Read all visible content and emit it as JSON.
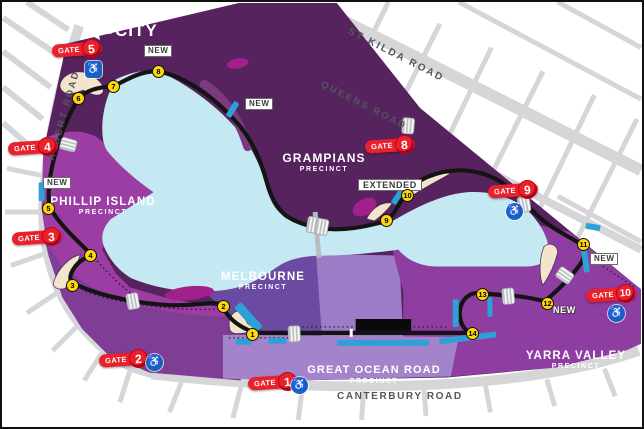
{
  "map": {
    "city": {
      "label": "CITY"
    },
    "roads": {
      "st_kilda": "ST KILDA ROAD",
      "queens": "QUEENS ROAD",
      "albert": "ALBERT ROAD",
      "canterbury": "CANTERBURY ROAD"
    },
    "precincts": {
      "phillip_island": {
        "name": "PHILLIP ISLAND",
        "sub": "PRECINCT"
      },
      "grampians": {
        "name": "GRAMPIANS",
        "sub": "PRECINCT"
      },
      "melbourne": {
        "name": "MELBOURNE",
        "sub": "PRECINCT"
      },
      "great_ocean_road": {
        "name": "GREAT OCEAN ROAD",
        "sub": "PRECINCT"
      },
      "yarra_valley": {
        "name": "YARRA VALLEY",
        "sub": "PRECINCT"
      }
    },
    "gates": [
      {
        "label": "GATE",
        "number": "1",
        "accessible": true
      },
      {
        "label": "GATE",
        "number": "2",
        "accessible": true
      },
      {
        "label": "GATE",
        "number": "3",
        "accessible": false
      },
      {
        "label": "GATE",
        "number": "4",
        "accessible": false
      },
      {
        "label": "GATE",
        "number": "5",
        "accessible": true
      },
      {
        "label": "GATE",
        "number": "8",
        "accessible": false
      },
      {
        "label": "GATE",
        "number": "9",
        "accessible": true
      },
      {
        "label": "GATE",
        "number": "10",
        "accessible": true
      }
    ],
    "turns": [
      "1",
      "2",
      "3",
      "4",
      "5",
      "6",
      "7",
      "8",
      "9",
      "10",
      "11",
      "12",
      "13",
      "14"
    ],
    "annotations": {
      "new": "NEW",
      "extended": "EXTENDED"
    },
    "icons": {
      "accessible": "♿"
    },
    "colors": {
      "precinct_dark": "#57235e",
      "precinct_bright": "#9c3da4",
      "precinct_mid": "#7f3d96",
      "melbourne": "#6b4aa2",
      "lavender_block": "#9c7cc6",
      "south_strip": "#a383ca",
      "yarra": "#8e3da0",
      "lake": "#c5e9f2",
      "track": "#141414",
      "road_gray": "#d6d6d8",
      "gate_red": "#e8212d",
      "turn_yellow": "#ffd60a",
      "grandstand_blue": "#2f9fd8",
      "accessible_blue": "#1465c0",
      "magenta_zone": "#a1208c",
      "cream_zone": "#f3e4cc"
    }
  }
}
